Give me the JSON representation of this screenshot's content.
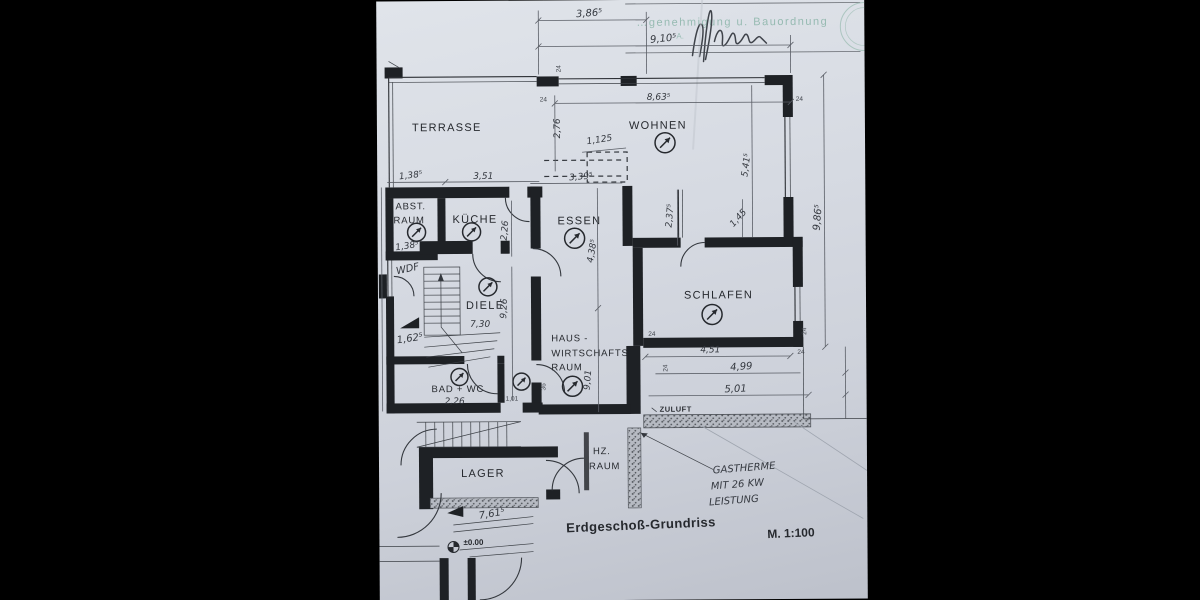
{
  "title_block": {
    "title": "Erdgeschoß-Grundriss",
    "scale": "M. 1:100"
  },
  "stamp": {
    "text": "…genehmigung u. Bauordnung",
    "initials": "A."
  },
  "rooms": {
    "terrasse": "TERRASSE",
    "wohnen": "WOHNEN",
    "abstellraum": {
      "l1": "ABST.",
      "l2": "RAUM"
    },
    "kueche": "KÜCHE",
    "essen": "ESSEN",
    "schlafen": "SCHLAFEN",
    "diele": "DIELE",
    "hwr": {
      "l1": "HAUS -",
      "l2": "WIRTSCHAFTS",
      "l3": "RAUM"
    },
    "bad": "BAD + WC",
    "lager": "LAGER",
    "hz": {
      "l1": "HZ.",
      "l2": "RAUM"
    }
  },
  "annotations": {
    "zuluft": "ZULUFT",
    "wdf": "WDF",
    "gastherme": {
      "l1": "GASTHERME",
      "l2": "MIT 26 KW",
      "l3": "LEISTUNG"
    },
    "level": "±0.00"
  },
  "dims": {
    "wall_thickness": "24",
    "top": {
      "left": "3,86⁵",
      "overall": "9,10⁵"
    },
    "wohnen": {
      "width": "8,63⁵",
      "depth": "5,41⁵",
      "window": "2,76",
      "offset": "1,125"
    },
    "right": {
      "overall": "9,86⁵"
    },
    "annex": {
      "abst_width": "1,38⁵",
      "kueche_width": "3,51",
      "kueche_depth": "2,26",
      "wdf_width": "1,38⁵",
      "entry": "1,62⁵"
    },
    "essen": {
      "width": "3,39⁵",
      "depth": "4,38⁵"
    },
    "nook": {
      "depth": "2,37⁵",
      "pass": "1,45"
    },
    "chains": {
      "hall_depth": "9,26",
      "south_depth": "9,01"
    },
    "schlafen": {
      "width": "4,51"
    },
    "south": {
      "inner": "4,99",
      "outer": "5,01"
    },
    "bad": {
      "width": "2,26",
      "door": "1,01",
      "niche": "36"
    },
    "diele": {
      "note": "7,30"
    },
    "site": {
      "front": "7,61⁵"
    }
  },
  "icons": {
    "room_symbol": "circled-arrow",
    "signature": "handwritten-signature-scribble",
    "level_marker": "survey-level-point",
    "entrance_triangle": "filled-triangle-marker"
  },
  "colors": {
    "paper": "#d6dae2",
    "ink": "#26292e",
    "stamp_green": "#5f9d87"
  }
}
